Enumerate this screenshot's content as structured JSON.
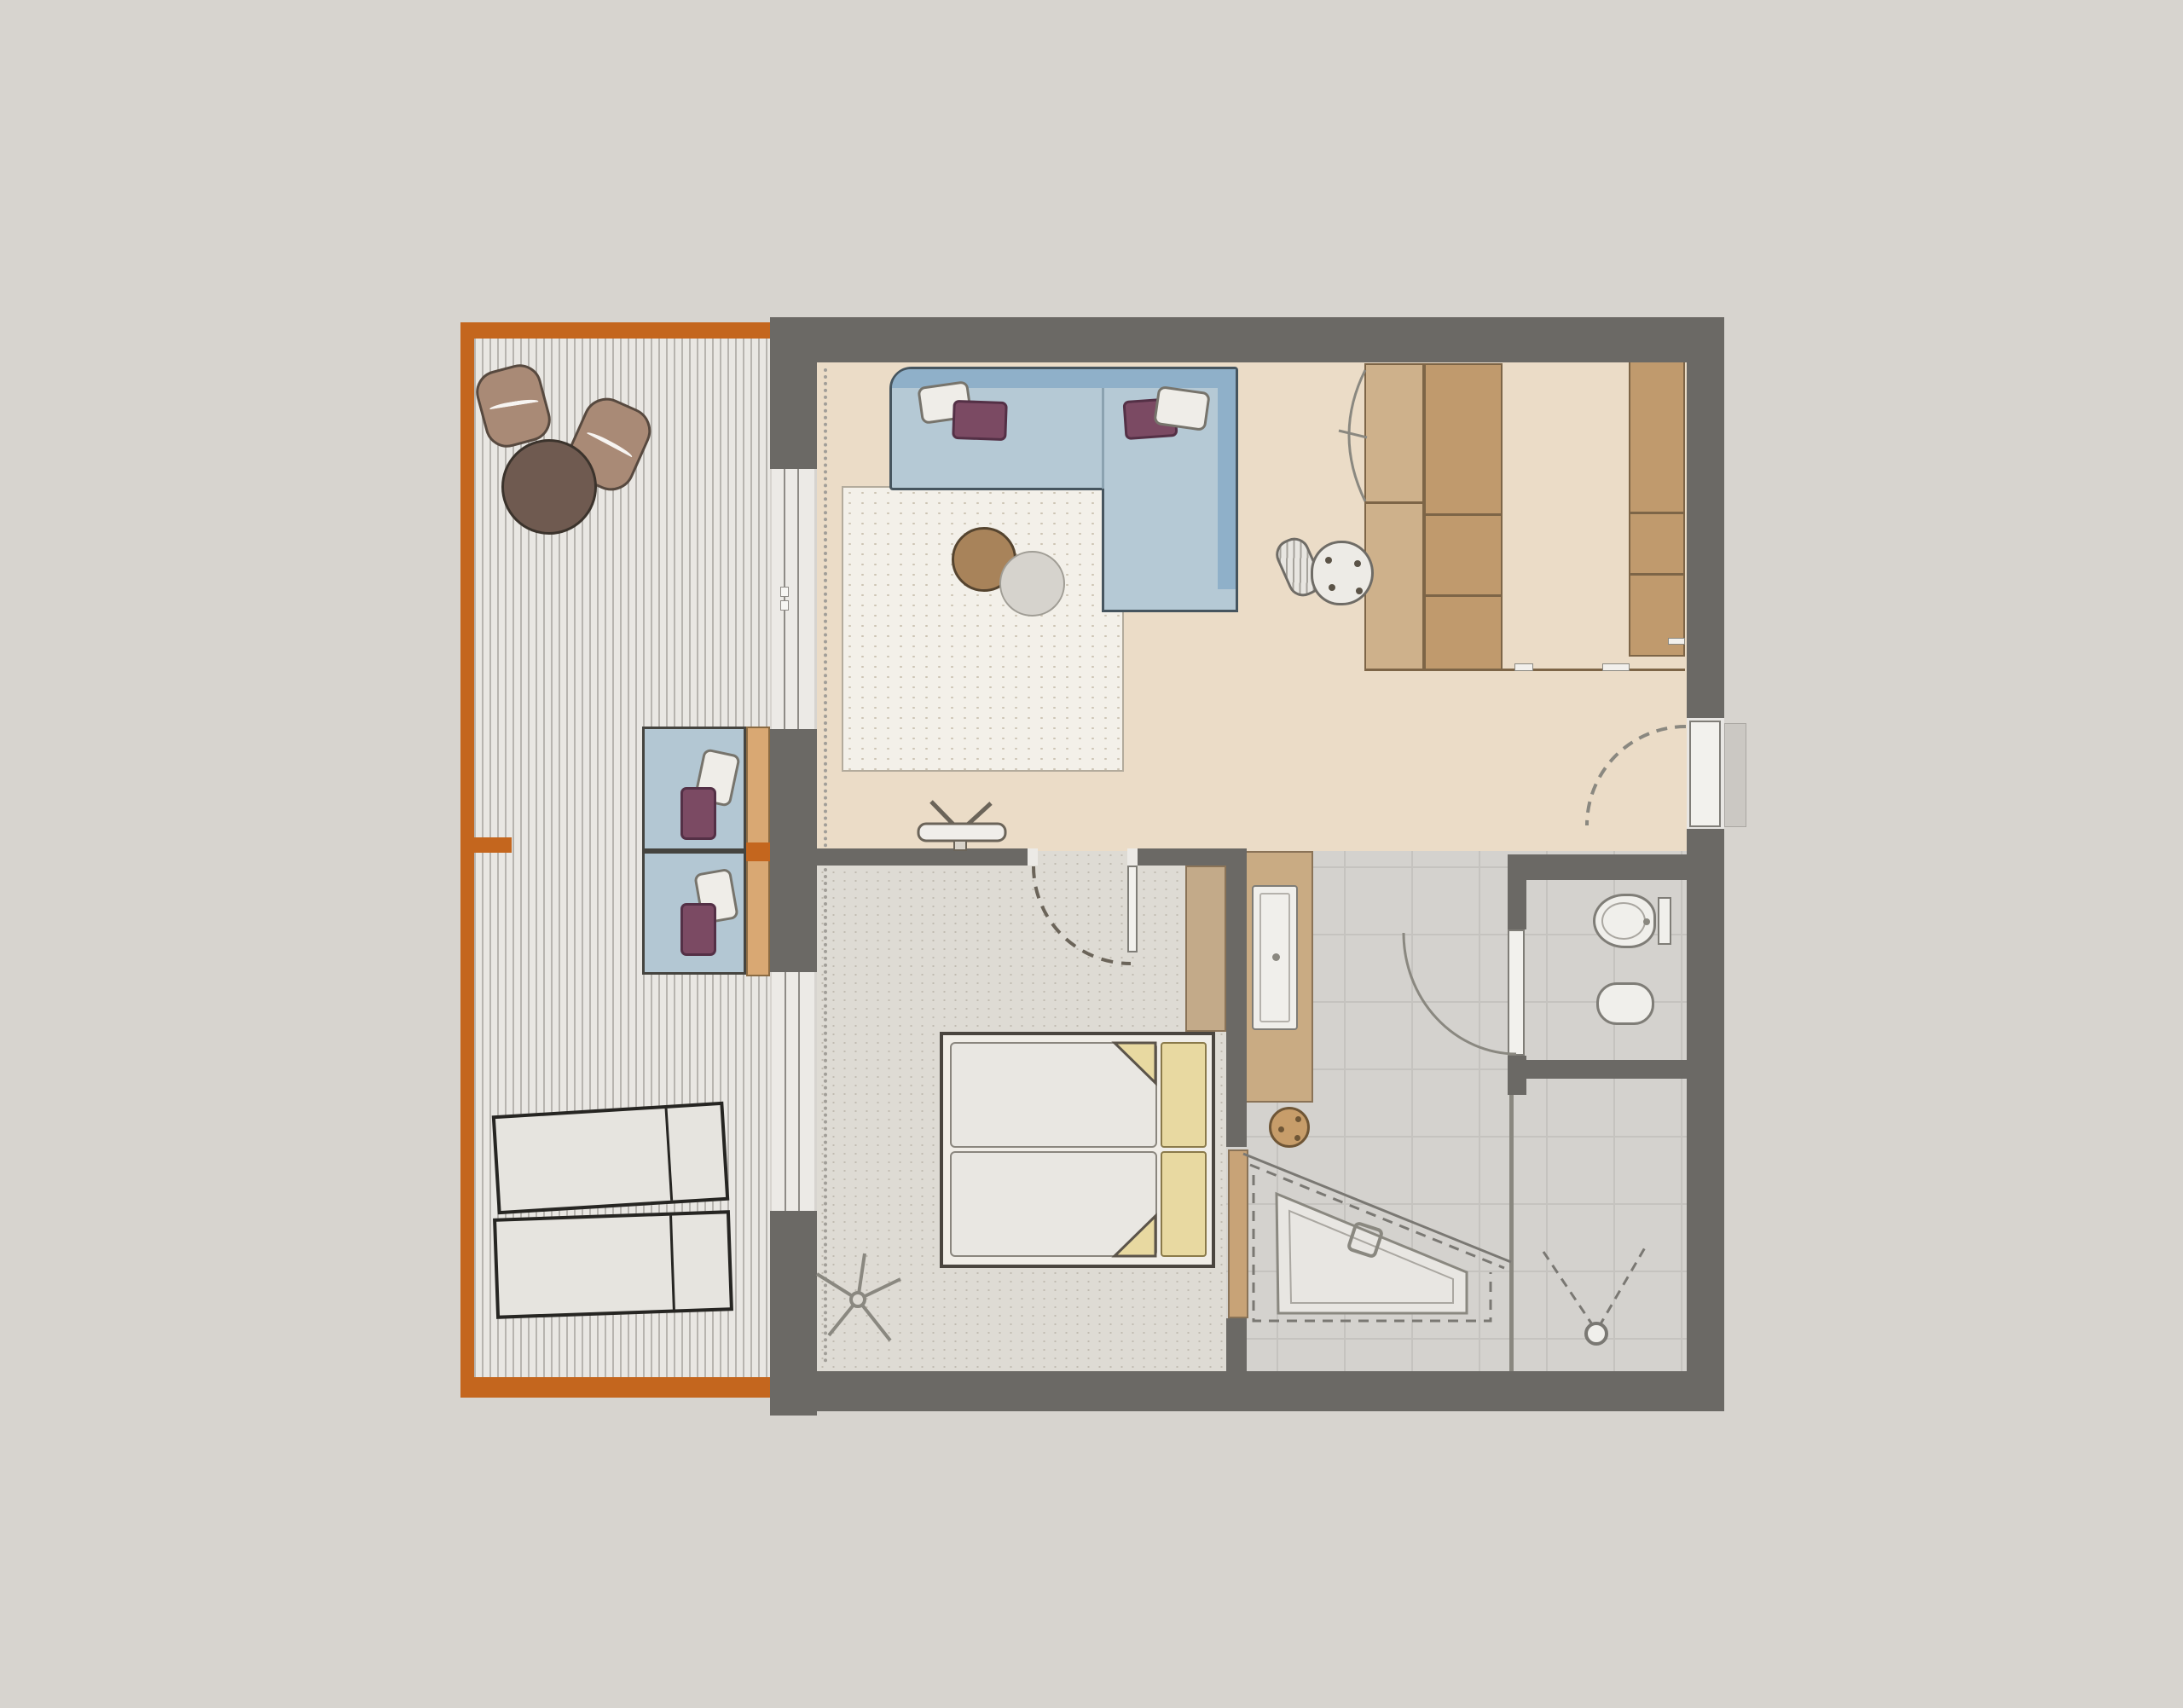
{
  "title": "Hotel suite floor plan with balcony",
  "palette": {
    "page_bg": "#d7d4cf",
    "wall": "#6b6965",
    "wall_light": "#cbc8c3",
    "accent_orange": "#c4661e",
    "deck": "#e9e7e3",
    "deck_stripe": "#b7b4af",
    "living_floor": "#ebdcc7",
    "bedroom_floor": "#dedbd4",
    "carpet_dot": "#c0bbb1",
    "tile": "#d4d2ce",
    "tile_grout": "#c5c3bf",
    "rug": "#f3f0e9",
    "rug_dot": "#cdc5b4",
    "sofa_light": "#b5c9d5",
    "sofa_dark": "#8fb0c9",
    "sofa_line": "#46555f",
    "pillow_white": "#efede8",
    "pillow_purple": "#7b4a63",
    "wood_light": "#ceb18b",
    "wood_dark": "#c09a6d",
    "wood_line": "#7d6547",
    "tan_wall": "#c3aa89",
    "tan_door": "#c8a377",
    "vanity": "#c9ab83",
    "backrest": "#d9a873",
    "stool": "#c79d6a",
    "ottoman": "#a98a76",
    "table_dark": "#6f5a50",
    "lounger": "#e6e4df",
    "lounger_line": "#262522",
    "fixture": "#f0efeb",
    "fixture_line": "#7f7d77",
    "line": "#8a8880",
    "bed_frame": "#f0ede7",
    "mattress": "#e9e7e2",
    "yellow": "#e8d9a1",
    "blue_chair": "#b3c7d3",
    "curtain": "#a19e98"
  },
  "legend": {
    "rooms": [
      {
        "name": "balcony",
        "furniture": [
          "wood deck",
          "two ottoman poufs",
          "round side table",
          "two sun loungers",
          "two cushioned bench seats with pillows"
        ]
      },
      {
        "name": "living-room",
        "furniture": [
          "L-shaped sofa with four pillows",
          "square rug",
          "round coffee table",
          "pouf",
          "TV on sideboard",
          "wardrobe columns",
          "desk chair",
          "curtain"
        ]
      },
      {
        "name": "bedroom",
        "furniture": [
          "double bed with two mattresses",
          "headboard",
          "floor lamp",
          "curtain",
          "window to balcony"
        ]
      },
      {
        "name": "bathroom",
        "furniture": [
          "vanity counter with sink",
          "round stool",
          "corner shower tray",
          "walk-in shower head",
          "sliding door"
        ]
      },
      {
        "name": "wc",
        "furniture": [
          "toilet",
          "bidet",
          "swing door"
        ]
      }
    ],
    "doors": [
      "apartment entrance door (right wall)",
      "bedroom swing door",
      "wc swing door",
      "balcony sliding door"
    ]
  }
}
